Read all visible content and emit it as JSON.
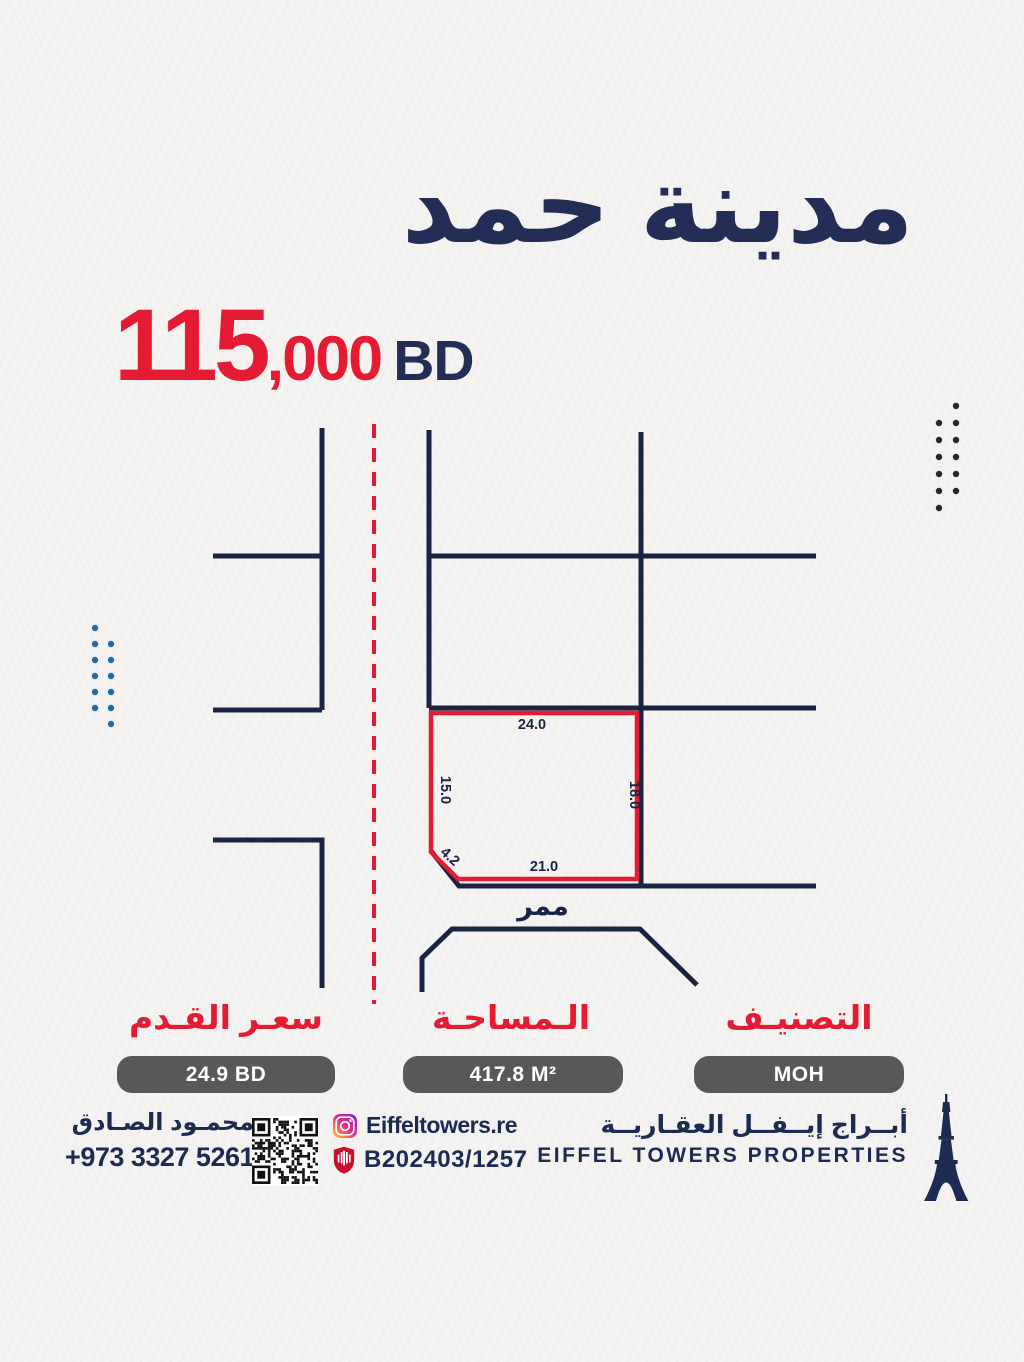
{
  "title": "مدينة حمد",
  "price": {
    "amount": "115",
    "thousands": ",000",
    "currency": "BD"
  },
  "map": {
    "passage_label": "ممر",
    "plot_dimensions": {
      "top": "24.0",
      "left": "15.0",
      "right": "18.0",
      "bottom": "21.0",
      "corner": "4.2"
    }
  },
  "specs": {
    "price_per_foot": {
      "label": "سعـر القـدم",
      "value": "24.9 BD"
    },
    "area": {
      "label": "الـمساحـة",
      "value": "417.8 M²"
    },
    "classification": {
      "label": "التصنيـف",
      "value": "MOH"
    }
  },
  "footer": {
    "agent_name": "محمـود الصـادق",
    "phone": "+973 3327 5261",
    "instagram_handle": "Eiffeltowers.re",
    "license_number": "B202403/1257",
    "company_name_ar": "أبــراج إيــفــل العقـاريــة",
    "company_name_en": "EIFFEL TOWERS PROPERTIES"
  },
  "icons": {
    "instagram": "instagram-icon",
    "license": "license-shield-icon",
    "qr": "qr-code",
    "logo": "eiffel-tower-icon"
  },
  "colors": {
    "accent_red": "#e41b32",
    "navy_ink": "#232d55",
    "line_navy": "#1a2342",
    "value_box_gray": "#57585a",
    "dots_blue": "#1e6da4",
    "dots_dark": "#26272b",
    "background": "#f4f3f1"
  }
}
